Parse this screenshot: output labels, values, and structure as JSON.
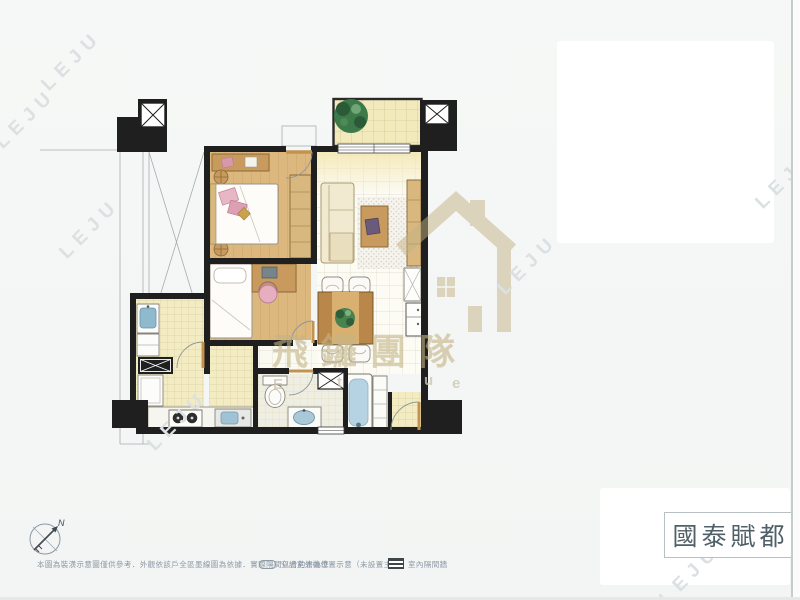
{
  "title": {
    "text": "國泰賦都"
  },
  "watermark": {
    "leju_text": "LEJU",
    "team_name": "飛鑼團隊",
    "latin_letters": [
      "E",
      "t",
      "u",
      "e"
    ],
    "logo_color": "#c3b182"
  },
  "compass": {
    "north_label": "N"
  },
  "footer": {
    "disclaimer": "本圖為裝潢示意圖僅供參考．外觀依該戶全區墨線圖為依據．實際隔間以合約書為準",
    "legend": [
      {
        "label": "空調室外機位置示意（未設置主機）",
        "icon": "outline-rounded-rect"
      },
      {
        "label": "室內隔間牆",
        "icon": "striped-wall-block"
      }
    ]
  },
  "colors": {
    "wall": "#1f1f1f",
    "wood_floor": "#dcb77e",
    "tile_yellow": "#f3ecc3",
    "water_blue": "#a9c8d8",
    "plant_green": "#3c7a49",
    "pillow_pink": "#e3a8bc",
    "watermark_gold": "#c3b182",
    "footer_gray": "#8a97a3",
    "title_gray": "#4f6069"
  }
}
